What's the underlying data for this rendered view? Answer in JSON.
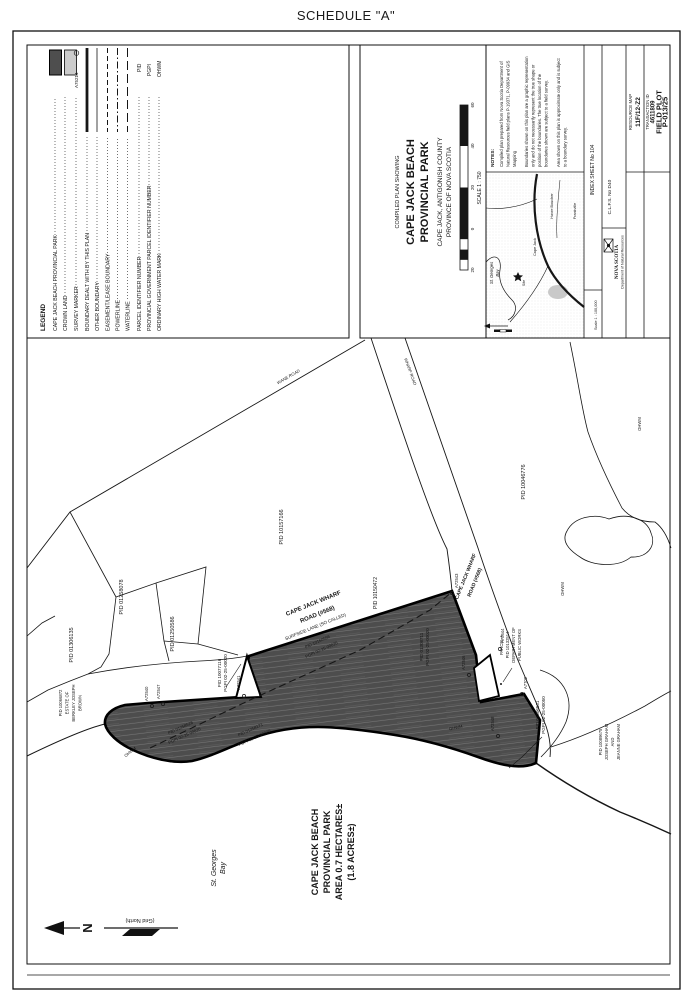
{
  "page": {
    "schedule_title": "SCHEDULE \"A\""
  },
  "legend": {
    "title": "LEGEND",
    "items": [
      {
        "label": "CAPE JACK BEACH PROVINCIAL PARK",
        "value": ""
      },
      {
        "label": "CROWN LAND",
        "value": ""
      },
      {
        "label": "SURVEY MARKER",
        "value": "A75214"
      },
      {
        "label": "BOUNDARY DEALT WITH BY THIS PLAN",
        "value": ""
      },
      {
        "label": "OTHER BOUNDARY",
        "value": ""
      },
      {
        "label": "EASEMENT/LEASE BOUNDARY",
        "value": ""
      },
      {
        "label": "POWERLINE",
        "value": ""
      },
      {
        "label": "WATERLINE",
        "value": ""
      },
      {
        "label": "PARCEL IDENTIFIER NUMBER",
        "value": "PID"
      },
      {
        "label": "PROVINCIAL GOVERNMENT PARCEL IDENTIFIER NUMBER",
        "value": "PGPI"
      },
      {
        "label": "ORDINARY HIGH WATER MARK",
        "value": "OHWM"
      }
    ]
  },
  "title_block": {
    "subtitle": "COMPILED PLAN SHOWING",
    "title1": "CAPE JACK BEACH",
    "title2": "PROVINCIAL PARK",
    "loc1": "CAPE JACK, ANTIGONISH COUNTY",
    "loc2": "PROVINCE OF NOVA SCOTIA",
    "scale_label": "SCALE 1 : 750",
    "ticks": [
      "20",
      "0",
      "20",
      "40",
      "60"
    ]
  },
  "notes": {
    "title": "NOTES:",
    "p1a": "Compiled plan prepared from Nova Scotia Department of",
    "p1b": "Natural Resources field plans P-19371, P-09934 and GIS",
    "p1c": "Mapping",
    "p2a": "Boundaries shown on this plan are a graphic representation",
    "p2b": "only and do not necessarily represent the true shape or",
    "p2c": "position of the boundaries. The true location of the",
    "p2d": "boundaries shown are subject to a field survey.",
    "p3a": "Area shown on this plan is approximate only and is subject",
    "p3b": "to a boundary survey."
  },
  "location_map": {
    "bay1": "St. Georges",
    "bay2": "Bay",
    "cape": "Cape Jack",
    "havre": "Havre Boucher",
    "frankville": "Frankville",
    "site": "Site",
    "scale": "Scale 1 : 100,000"
  },
  "info_block": {
    "index_sheet": "INDEX SHEET No 104",
    "clfs": "C.L.F.S. No D40",
    "agency": "NOVA SCOTIA",
    "dept": "Department of Natural Resources",
    "resource_map_label": "RESOURCE MAP",
    "resource_map": "11F/12-Z2",
    "transaction_label": "TRANSACTION ID",
    "transaction_id": "4611809",
    "field_plot_label": "FIELD PLOT",
    "field_plot": "P-013/25"
  },
  "map": {
    "park_name1": "CAPE JACK BEACH",
    "park_name2": "PROVINCIAL PARK",
    "park_area1": "AREA 0.7 HECTARES±",
    "park_area2": "(1.8 ACRES±)",
    "bay1": "St. Georges",
    "bay2": "Bay",
    "north": "N",
    "grid_north": "(Grid North)",
    "road1": "CAPE JACK WHARF",
    "road2": "ROAD (#568)",
    "surfside": "SURFSIDE LANE (SO CALLED)",
    "wharf_road": "WHARF ROAD",
    "wane_road": "WANE ROAD",
    "ohwm": "OHWM",
    "pids": {
      "p01306135": "PID 01306135",
      "p01258078": "PID 01258078",
      "p01250586": "PID 01250586",
      "p10157166": "PID 10157166",
      "p10046776": "PID 10046776",
      "p10150472": "PID 10150472",
      "lane": [
        "PID 10077116",
        "PGPI 02-25-00020"
      ],
      "west": [
        "PID 01258528",
        "PGPI 02-25-00020"
      ],
      "mid": [
        "PID 01258171",
        "PGPI 02-25-00020"
      ],
      "finger": [
        "PID 10160556",
        "PGPI 02-25-00020"
      ],
      "east": [
        "PID 01308711",
        "PGPI 02-25-00020"
      ],
      "parcel_a": [
        "PARCEL A",
        "PID 10132514",
        "DEPARTMENT OF",
        "PUBLIC WORKS"
      ],
      "south": [
        "PID 01306531",
        "PGPI 02-25-00050"
      ],
      "graham": [
        "PID 10089675",
        "JOSEPH GRAHAM",
        "AND",
        "JEANNE GRAHAM"
      ],
      "estate": [
        "PID 10066872",
        "ESTATE OF",
        "BERKLEY JOSEPH",
        "BROWN"
      ]
    },
    "markers": [
      "A72540",
      "A72547",
      "A72541",
      "A72546",
      "A72543",
      "A72544",
      "A7702",
      "A72548"
    ]
  }
}
